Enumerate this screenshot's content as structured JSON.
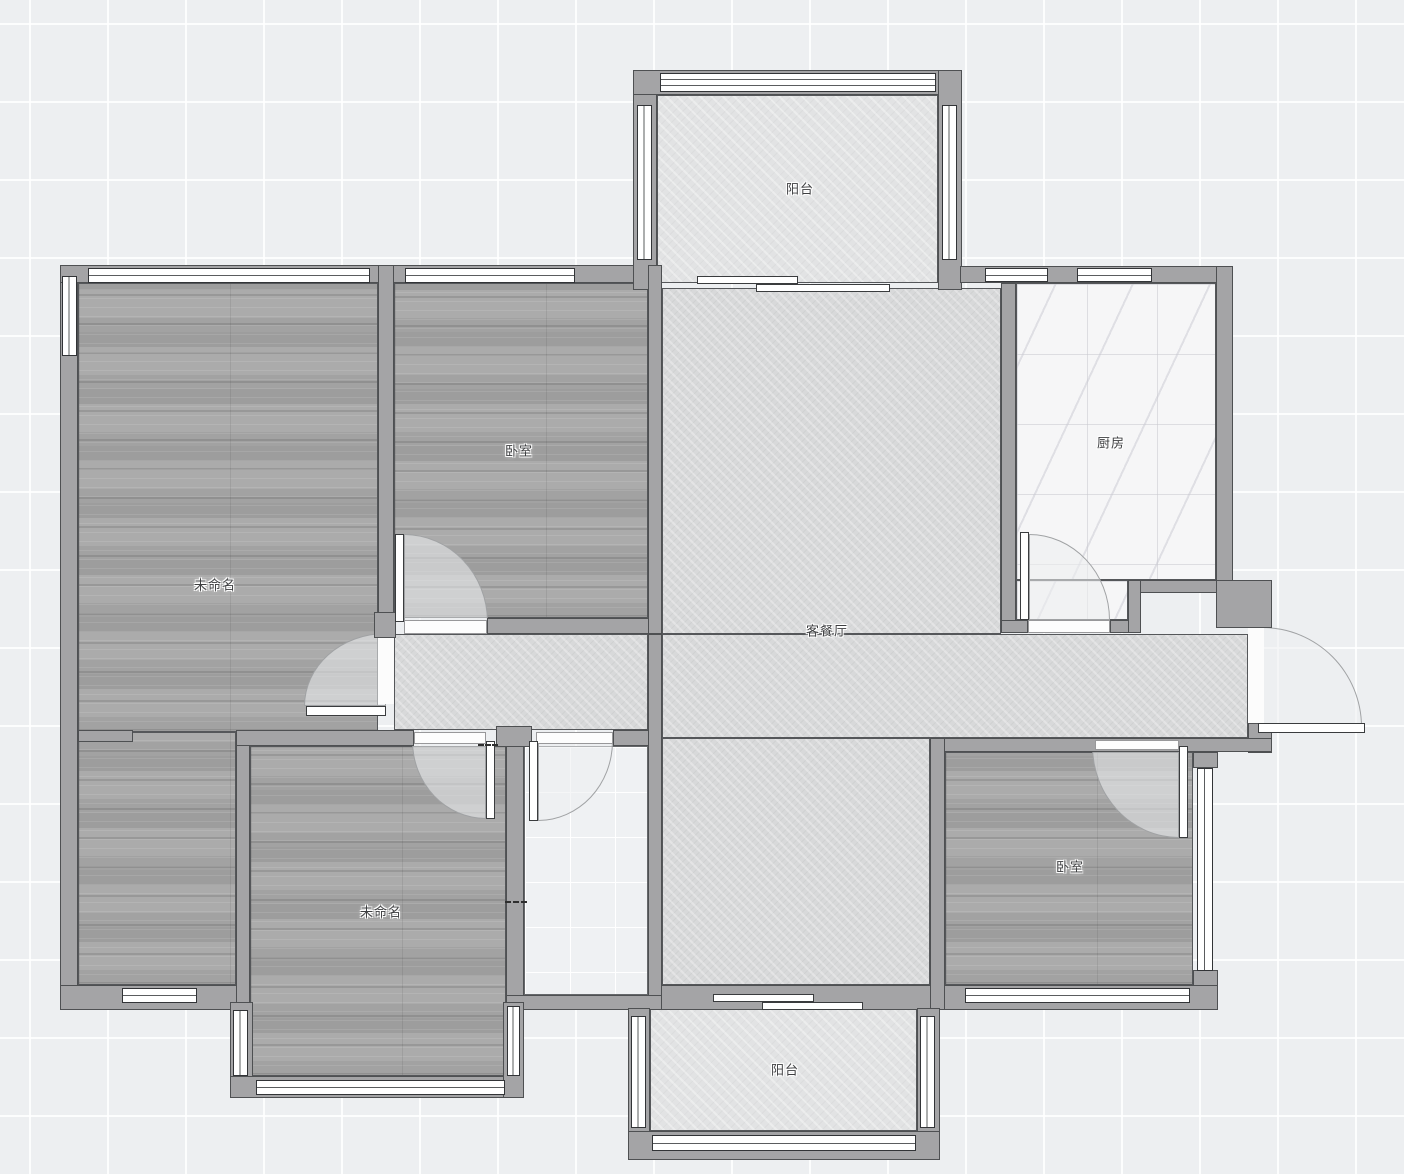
{
  "canvas": {
    "width": 1404,
    "height": 1174,
    "app": "floor-plan-editor"
  },
  "colors": {
    "background": "#edeff1",
    "grid_line": "#ffffff",
    "wall_fill": "#a4a4a6",
    "wall_outline": "#4e5052",
    "wood_floor": "#a7a7a7",
    "living_tile": "#d8d9da",
    "balcony_tile": "#e2e3e4",
    "kitchen_tile": "#f6f6f7",
    "bathroom_tile": "#eff1f3",
    "window_fill": "#ffffff",
    "label_text": "#3e3f41"
  },
  "rooms": [
    {
      "id": "balcony-top",
      "label": "阳台"
    },
    {
      "id": "bedroom-top",
      "label": "卧室"
    },
    {
      "id": "unnamed-left",
      "label": "未命名"
    },
    {
      "id": "kitchen",
      "label": "厨房"
    },
    {
      "id": "living-dining",
      "label": "客餐厅"
    },
    {
      "id": "unnamed-bottom",
      "label": "未命名"
    },
    {
      "id": "bedroom-right",
      "label": "卧室"
    },
    {
      "id": "balcony-bottom",
      "label": "阳台"
    }
  ]
}
